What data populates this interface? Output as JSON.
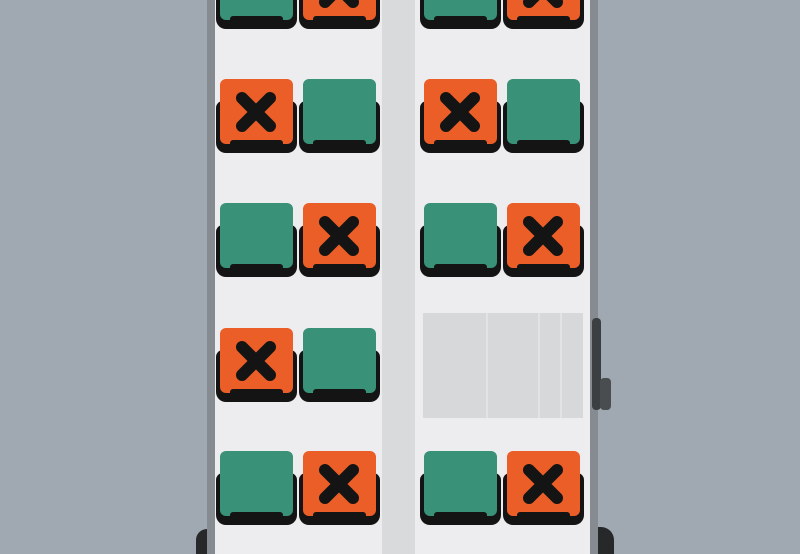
{
  "scene": {
    "description": "Top-down bus interior seat availability map",
    "vehicle": "bus"
  },
  "colors": {
    "background": "#A0A9B1",
    "floor": "#EDEDEF",
    "aisle": "#D9DADC",
    "wall": "#858B90",
    "seat_available": "#399178",
    "seat_occupied": "#EB5E28",
    "seat_frame": "#141414",
    "panel": "#D7D8DA",
    "panel_seam": "#E2E3E5",
    "door": "#3C3F42",
    "door_handle": "#4A4D50",
    "wheel": "#26282A"
  },
  "seat_map": {
    "seats_per_row_side": 2,
    "occupied_marker_icon": "x-icon",
    "rows": [
      {
        "left": [
          "available",
          "occupied"
        ],
        "right": [
          "available",
          "occupied"
        ]
      },
      {
        "left": [
          "occupied",
          "available"
        ],
        "right": [
          "occupied",
          "available"
        ]
      },
      {
        "left": [
          "available",
          "occupied"
        ],
        "right": [
          "available",
          "occupied"
        ]
      },
      {
        "left": [
          "occupied",
          "available"
        ],
        "right": null,
        "right_feature": "luggage-panel"
      },
      {
        "left": [
          "available",
          "occupied"
        ],
        "right": [
          "available",
          "occupied"
        ]
      }
    ],
    "counts": {
      "available": 9,
      "occupied": 9
    }
  },
  "fixtures": {
    "luggage_panel_segments": 4,
    "side_door_position": "right",
    "rear_wheels": 2
  }
}
